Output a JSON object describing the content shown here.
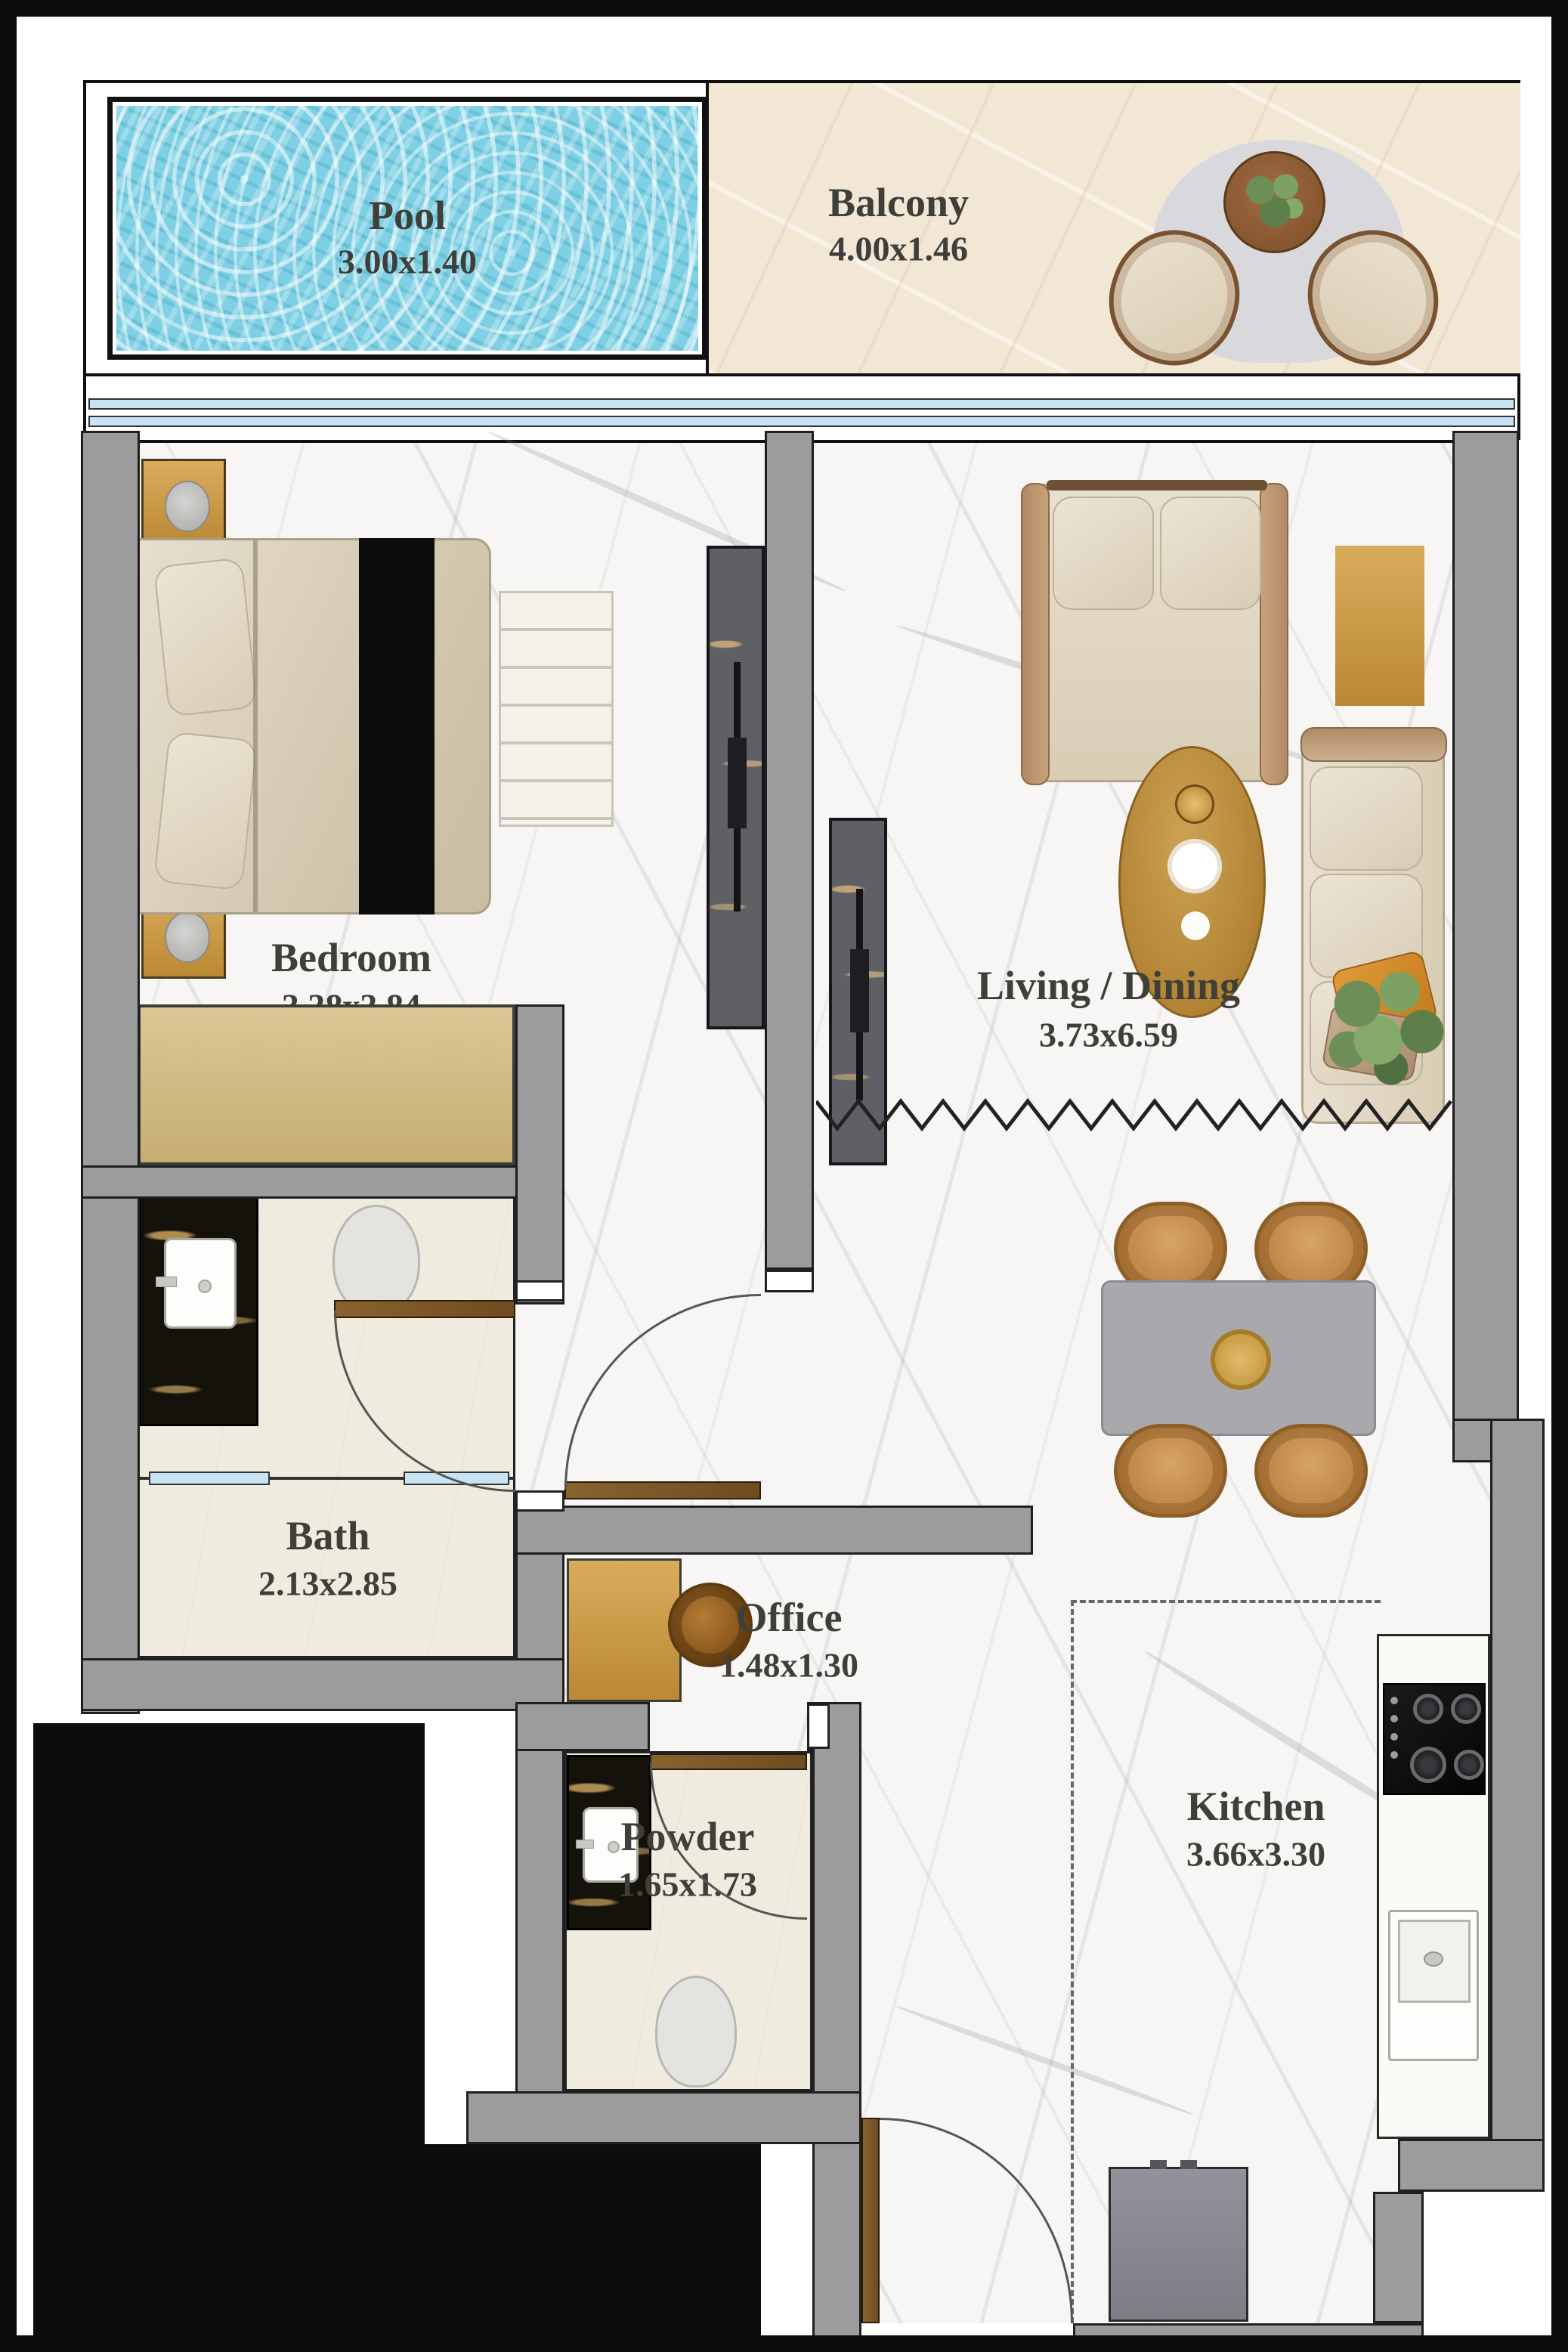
{
  "title": "Apartment Floor Plan",
  "rooms": {
    "pool": {
      "name": "Pool",
      "dims": "3.00x1.40"
    },
    "balcony": {
      "name": "Balcony",
      "dims": "4.00x1.46"
    },
    "bedroom": {
      "name": "Bedroom",
      "dims": "3.38x3.84"
    },
    "living": {
      "name": "Living / Dining",
      "dims": "3.73x6.59"
    },
    "bath": {
      "name": "Bath",
      "dims": "2.13x2.85"
    },
    "office": {
      "name": "Office",
      "dims": "1.48x1.30"
    },
    "powder": {
      "name": "Powder",
      "dims": "1.65x1.73"
    },
    "kitchen": {
      "name": "Kitchen",
      "dims": "3.66x3.30"
    }
  },
  "colors": {
    "wall": "#9c9c9c",
    "pool_water": "#7fd0e4",
    "gold": "#c89544",
    "wood_door": "#7d5a2e",
    "glass": "#c8e4f2",
    "label_text": "#3f3f3a",
    "exterior": "#0d0d0d"
  }
}
